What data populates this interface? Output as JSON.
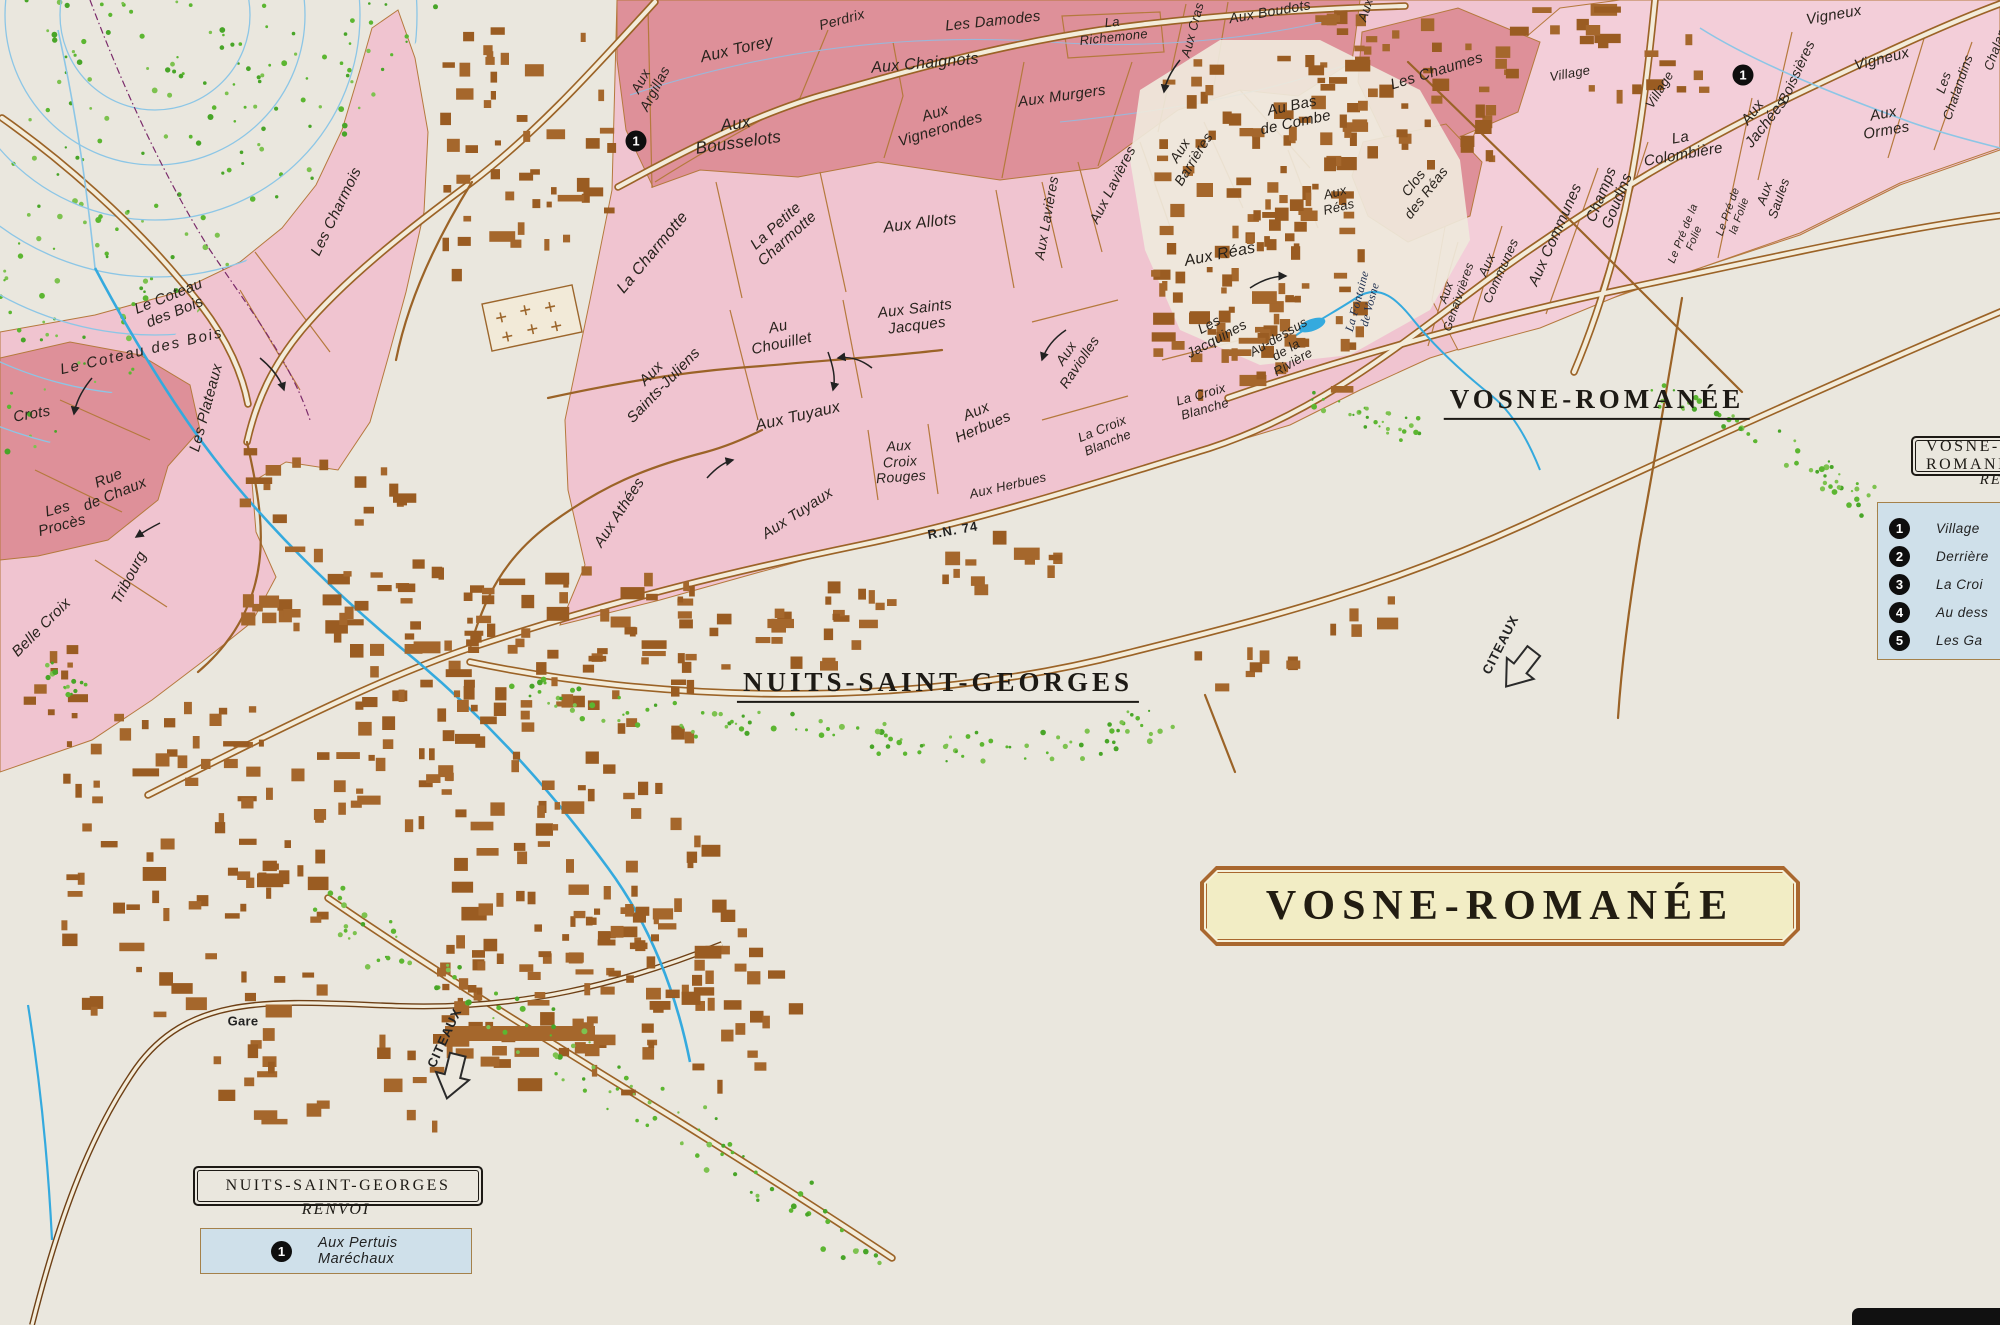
{
  "colors": {
    "paper": "#eae7de",
    "vineyard_pink": "#f0c4d0",
    "vineyard_rose": "#de9099",
    "communes_pink": "#f3ced9",
    "road_brown": "#9b6327",
    "building_brown": "#a5672c",
    "stream_blue": "#35aade",
    "contour_blue": "#8cc6e6",
    "legend_blue": "#cfe0ea",
    "banner_yellow": "#f2edc5",
    "banner_border": "#a9672e"
  },
  "banner": {
    "text": "VOSNE-ROMANÉE"
  },
  "legend_nsg": {
    "title": "NUITS-SAINT-GEORGES",
    "subtitle": "RENVOI",
    "items": [
      {
        "num": "1",
        "label": "Aux Pertuis Maréchaux"
      }
    ]
  },
  "legend_vosne": {
    "title": "VOSNE-ROMANÉE",
    "subtitle": "RENVOI",
    "items": [
      {
        "num": "1",
        "label": "Village"
      },
      {
        "num": "2",
        "label": "Derrière"
      },
      {
        "num": "3",
        "label": "La Croi"
      },
      {
        "num": "4",
        "label": "Au dess"
      },
      {
        "num": "5",
        "label": "Les Ga"
      }
    ]
  },
  "map": {
    "markers": [
      {
        "num": "1",
        "x": 636,
        "y": 141
      },
      {
        "num": "1",
        "x": 1743,
        "y": 75
      }
    ],
    "labels": [
      {
        "t": "Le Coteau\ndes Bois",
        "x": 172,
        "y": 305,
        "r": -22,
        "s": 15
      },
      {
        "t": "Le Coteau des Bois",
        "x": 142,
        "y": 352,
        "r": -13,
        "s": 15,
        "ls": 2
      },
      {
        "t": "Les Charmois",
        "x": 337,
        "y": 212,
        "r": -64,
        "s": 15
      },
      {
        "t": "Les Plateaux",
        "x": 207,
        "y": 408,
        "r": -75,
        "s": 15
      },
      {
        "t": "Crots",
        "x": 32,
        "y": 415,
        "r": -10,
        "s": 15
      },
      {
        "t": "Rue\nde Chaux",
        "x": 112,
        "y": 487,
        "r": -22,
        "s": 15
      },
      {
        "t": "Les\nProcès",
        "x": 60,
        "y": 518,
        "r": -15,
        "s": 15
      },
      {
        "t": "Tribourg",
        "x": 130,
        "y": 578,
        "r": -62,
        "s": 15
      },
      {
        "t": "Belle Croix",
        "x": 42,
        "y": 628,
        "r": -45,
        "s": 15
      },
      {
        "t": "Aux\nArgillas",
        "x": 648,
        "y": 85,
        "r": -62,
        "s": 14
      },
      {
        "t": "Aux Torey",
        "x": 737,
        "y": 50,
        "r": -13,
        "s": 16
      },
      {
        "t": "Perdrix",
        "x": 842,
        "y": 20,
        "r": -15,
        "s": 14
      },
      {
        "t": "Les Damodes",
        "x": 993,
        "y": 22,
        "r": -6,
        "s": 15
      },
      {
        "t": "Aux Chaignots",
        "x": 925,
        "y": 64,
        "r": -5,
        "s": 16
      },
      {
        "t": "Aux\nVignerondes",
        "x": 938,
        "y": 122,
        "r": -17,
        "s": 15
      },
      {
        "t": "Aux Murgers",
        "x": 1062,
        "y": 97,
        "r": -8,
        "s": 15
      },
      {
        "t": "La\nRichemone",
        "x": 1113,
        "y": 30,
        "r": -6,
        "s": 13
      },
      {
        "t": "Aux Cras",
        "x": 1193,
        "y": 30,
        "r": -75,
        "s": 13
      },
      {
        "t": "Aux Boudots",
        "x": 1270,
        "y": 12,
        "r": -10,
        "s": 14
      },
      {
        "t": "Aux",
        "x": 1366,
        "y": 10,
        "r": -72,
        "s": 13
      },
      {
        "t": "Aux\nBousselots",
        "x": 737,
        "y": 133,
        "r": -8,
        "s": 17
      },
      {
        "t": "Les Chaumes",
        "x": 1437,
        "y": 72,
        "r": -17,
        "s": 15
      },
      {
        "t": "Au Bas\nde Combe",
        "x": 1294,
        "y": 115,
        "r": -12,
        "s": 15
      },
      {
        "t": "Aux\nBarrières",
        "x": 1187,
        "y": 155,
        "r": -58,
        "s": 14
      },
      {
        "t": "Aux Lavières",
        "x": 1113,
        "y": 185,
        "r": -63,
        "s": 14
      },
      {
        "t": "Aux Lavières",
        "x": 1047,
        "y": 218,
        "r": -80,
        "s": 14
      },
      {
        "t": "Aux\nRéas",
        "x": 1337,
        "y": 200,
        "r": -14,
        "s": 13
      },
      {
        "t": "Clos\ndes Réas",
        "x": 1420,
        "y": 188,
        "r": -52,
        "s": 14
      },
      {
        "t": "Aux Réas",
        "x": 1220,
        "y": 255,
        "r": -11,
        "s": 16
      },
      {
        "t": "La Charmotte",
        "x": 653,
        "y": 253,
        "r": -50,
        "s": 16
      },
      {
        "t": "La Petite\nCharmotte",
        "x": 782,
        "y": 233,
        "r": -42,
        "s": 15
      },
      {
        "t": "Aux Allots",
        "x": 920,
        "y": 224,
        "r": -7,
        "s": 16
      },
      {
        "t": "Aux\nSaints-Juliens",
        "x": 658,
        "y": 380,
        "r": -46,
        "s": 15
      },
      {
        "t": "Au\nChouillet",
        "x": 780,
        "y": 336,
        "r": -12,
        "s": 15
      },
      {
        "t": "Aux Saints\nJacques",
        "x": 916,
        "y": 318,
        "r": -7,
        "s": 15
      },
      {
        "t": "Aux Tuyaux",
        "x": 798,
        "y": 417,
        "r": -13,
        "s": 16
      },
      {
        "t": "Aux Tuyaux",
        "x": 798,
        "y": 514,
        "r": -33,
        "s": 15
      },
      {
        "t": "Aux Athées",
        "x": 620,
        "y": 513,
        "r": -57,
        "s": 15
      },
      {
        "t": "Aux\nCroix\nRouges",
        "x": 900,
        "y": 462,
        "r": -4,
        "s": 14
      },
      {
        "t": "Aux\nHerbues",
        "x": 980,
        "y": 420,
        "r": -23,
        "s": 15
      },
      {
        "t": "Aux Herbues",
        "x": 1008,
        "y": 486,
        "r": -13,
        "s": 13
      },
      {
        "t": "Aux\nRaviolles",
        "x": 1073,
        "y": 358,
        "r": -56,
        "s": 14
      },
      {
        "t": "Les\nJacquines",
        "x": 1213,
        "y": 332,
        "r": -28,
        "s": 14
      },
      {
        "t": "La Croix\nBlanche",
        "x": 1105,
        "y": 436,
        "r": -22,
        "s": 13
      },
      {
        "t": "La Croix\nBlanche",
        "x": 1203,
        "y": 402,
        "r": -16,
        "s": 13
      },
      {
        "t": "Au-dessus\nde la\nRivière",
        "x": 1286,
        "y": 350,
        "r": -30,
        "s": 13
      },
      {
        "t": "La Fontaine\nde Vosne",
        "x": 1364,
        "y": 303,
        "r": -75,
        "s": 12,
        "st": "stream"
      },
      {
        "t": "Aux\nGenaivrières",
        "x": 1453,
        "y": 295,
        "r": -71,
        "s": 12
      },
      {
        "t": "Aux\nCommunes",
        "x": 1494,
        "y": 268,
        "r": -66,
        "s": 13
      },
      {
        "t": "Aux Communes",
        "x": 1556,
        "y": 235,
        "r": -66,
        "s": 15
      },
      {
        "t": "Champs\nGoudins",
        "x": 1610,
        "y": 198,
        "r": -68,
        "s": 15
      },
      {
        "t": "La\nColombière",
        "x": 1682,
        "y": 147,
        "r": -10,
        "s": 15
      },
      {
        "t": "Village",
        "x": 1570,
        "y": 74,
        "r": -10,
        "s": 13
      },
      {
        "t": "Village",
        "x": 1660,
        "y": 90,
        "r": -58,
        "s": 13
      },
      {
        "t": "Aux\nJachées",
        "x": 1760,
        "y": 118,
        "r": -52,
        "s": 15
      },
      {
        "t": "Boissières",
        "x": 1797,
        "y": 72,
        "r": -65,
        "s": 14
      },
      {
        "t": "Vigneux",
        "x": 1834,
        "y": 16,
        "r": -10,
        "s": 15
      },
      {
        "t": "Vigneux",
        "x": 1882,
        "y": 60,
        "r": -14,
        "s": 15
      },
      {
        "t": "Les\nChalandins",
        "x": 1951,
        "y": 85,
        "r": -71,
        "s": 13
      },
      {
        "t": "Aux\nOrmes",
        "x": 1885,
        "y": 123,
        "r": -10,
        "s": 15
      },
      {
        "t": "Aux\nSaules",
        "x": 1772,
        "y": 196,
        "r": -71,
        "s": 13
      },
      {
        "t": "Le Pré de\nla Folie",
        "x": 1734,
        "y": 214,
        "r": -70,
        "s": 11
      },
      {
        "t": "Le Pré de la\nFolie",
        "x": 1689,
        "y": 236,
        "r": -68,
        "s": 11
      },
      {
        "t": "Chalandins",
        "x": 2000,
        "y": 38,
        "r": -70,
        "s": 13
      },
      {
        "t": "R.N. 74",
        "x": 953,
        "y": 531,
        "r": -10,
        "s": 13,
        "st": "road"
      },
      {
        "t": "Gare",
        "x": 243,
        "y": 1022,
        "r": 0,
        "s": 13,
        "st": "place"
      },
      {
        "t": "CITEAUX",
        "x": 1501,
        "y": 645,
        "r": -63,
        "s": 13,
        "st": "road"
      },
      {
        "t": "CITEAUX",
        "x": 445,
        "y": 1038,
        "r": -65,
        "s": 13,
        "st": "road"
      },
      {
        "t": "NUITS-SAINT-GEORGES",
        "x": 938,
        "y": 685,
        "r": 0,
        "s": 27,
        "st": "town"
      },
      {
        "t": "VOSNE-ROMANÉE",
        "x": 1597,
        "y": 402,
        "r": 0,
        "s": 27,
        "st": "town"
      }
    ]
  }
}
